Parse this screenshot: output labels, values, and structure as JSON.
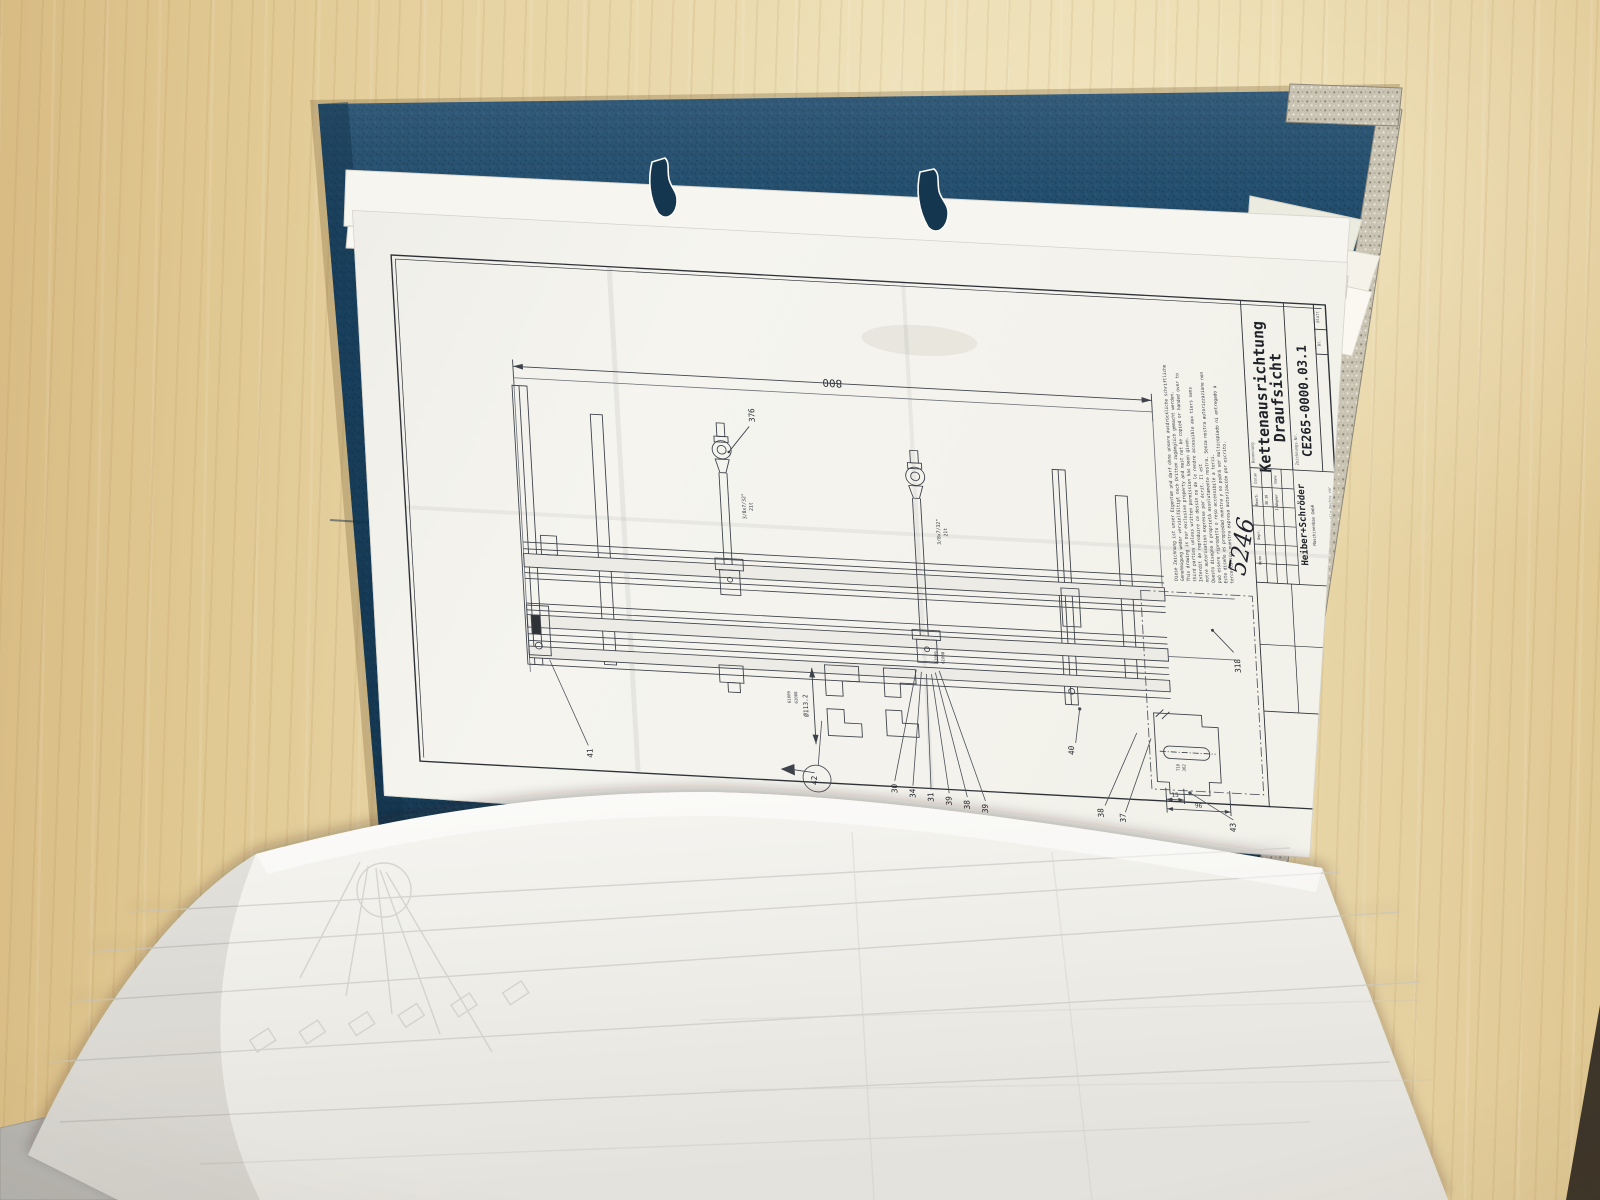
{
  "scene": {
    "binder_cover_color": "#1e4b6c",
    "metal_trim_color": "#cbc5b5",
    "wood_color": "#e8d5a6",
    "paper_color": "#f4f3ee"
  },
  "sheet": {
    "dim_800": "800",
    "dim_dia": "Ø113.2",
    "dim_15": "15",
    "dim_96": "96",
    "label_376": "376",
    "label_318": "318",
    "chain_spec_line1": "3/8x7/32\"",
    "chain_spec_line2": "21t",
    "chain_spec2_line1": "3/8x7/32\"",
    "chain_spec2_line2": "21t",
    "part_no_1": "61009",
    "part_no_2": "61008",
    "part_no_3": "61009",
    "part_no_4": "61008",
    "detail_note_1": "T10",
    "detail_note_2": "362",
    "callouts_bottom": [
      "41",
      "42",
      "30",
      "34",
      "31",
      "39",
      "38",
      "39",
      "40",
      "38",
      "37",
      "43"
    ],
    "notice_lines": [
      "Diese Zeichnung ist unser Eigentum und darf ohne unsere ausdrückliche schriftliche",
      "Genehmigung weder vervielfältigt noch Dritten zugänglich gemacht werden.",
      "This drawing is our exclusive property and must not be copied or handed over to",
      "third parties unless written permission has been given.",
      "Interdit de reproduire ce dessin ou de le rendre accessible aux tiers sans",
      "notre autorisation expresse par écrit. Il est",
      "Questo disegno è proprietà assolutamente nostra. Senza nostra autorizzazione non",
      "può essere riprodotto o reso accessibile a terzi.",
      "Este diseño es propiedad nuestra y no podrá ser multicopiado ni entregado a",
      "terceros sin nuestra expresa autorización por escrito."
    ],
    "title_block": {
      "benennung_label": "Benennung",
      "title_line1": "Kettenausrichtung",
      "title_line2": "Draufsicht",
      "zeichnungsnr_label": "Zeichnungs-Nr.",
      "drawing_number": "CE265-0000.03.1",
      "blatt_label": "Blatt",
      "bl_value": "Bl.",
      "company_name": "Heiber+Schröder",
      "company_sub": "Maschinenbau GmbH",
      "rights_footer": "Für diese Zeichnung behalten wir uns alle Rechte vor",
      "col_datum": "Datum",
      "col_name": "Name",
      "row_bearb": "Bearb.",
      "row_gepr": "Gepr.",
      "row_norm": "Norm",
      "bearb_datum": "30.10",
      "bearb_name": "I.Wagner",
      "handwritten": "5246"
    }
  }
}
